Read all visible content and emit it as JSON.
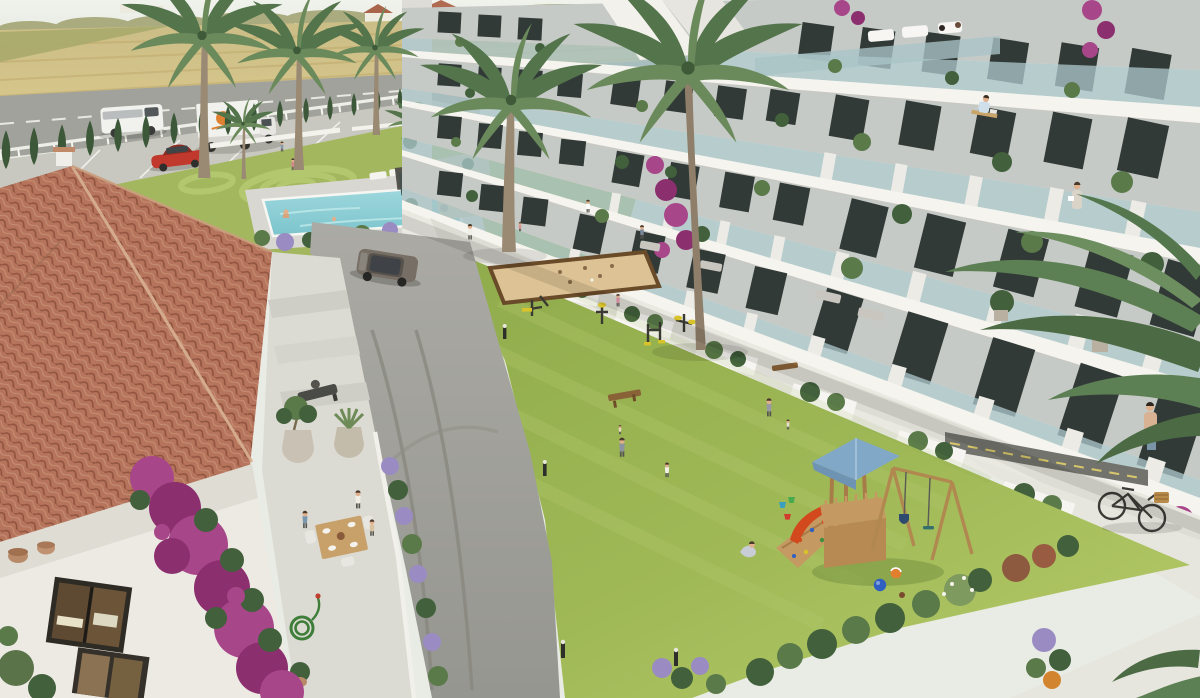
{
  "meta": {
    "title": "Aerial 3D architectural rendering of a coastal residential complex",
    "caption": "Bird's-eye render: white apartment block with tiered balconies on the right, central lawn courtyard with playground and outdoor gym, swimming pool, perimeter road with vehicles, and a terracotta-roofed Spanish house with dining terrace in the left foreground.",
    "width_px": 1200,
    "height_px": 698
  },
  "palette": {
    "sky": "#edf0ea",
    "fieldTan": "#d3c183",
    "fieldGreen": "#a8aa6c",
    "distantTrees": "#aaac80",
    "roadAsphalt": "#a2a29c",
    "parking": "#c8c8c0",
    "fenceWhite": "#eeeee8",
    "cypress": "#3c5839",
    "lawnUpper": "#a3b75f",
    "lawnMain": "#98b351",
    "lawnLight": "#b3c86c",
    "poolWater": "#8ed0d6",
    "poolDeck": "#d8d7d1",
    "gardenWall": "#f3f2ec",
    "driveway": "#a4a49e",
    "walkway": "#deddd5",
    "cornerPath": "#e7e6de",
    "accessRoad": "#73736d",
    "buildingWhite": "#f5f4ef",
    "buildingShade": "#c6cac6",
    "glassRail": "#a9c4c7",
    "windowDark": "#323a37",
    "partition": "#edebe6",
    "roofTile": "#b5745b",
    "roofTileDeep": "#8e523e",
    "roofTileLight": "#cb9a7e",
    "houseWall": "#eceae3",
    "terrace": "#dcdbd3",
    "bougainvillea": "#a8468a",
    "bougainvilleaDeep": "#8c2f6f",
    "leafGreen": "#5a7a4a",
    "leafDark": "#41603b",
    "lavender": "#9a8cc2",
    "sandCourt": "#dcc294",
    "sandBorder": "#6a4b29",
    "playWood": "#c59a62",
    "playRoof": "#81a8c6",
    "slideRed": "#d2491e",
    "ballBlue": "#2f5fc0",
    "ballOrange": "#e07f2e",
    "suv": "#776f66",
    "carRed": "#c0392c",
    "truckWhite": "#f1f1ee",
    "truckLogo": "#e0812f",
    "palmTrunk": "#9a8a74",
    "palmFrond": "#5d7f54",
    "palmFrondDark": "#4c6b45",
    "skin": "#e0b08d"
  },
  "scene": {
    "setting": "sunny coastal countryside, haze on horizon",
    "regions": [
      {
        "name": "farm-fields",
        "label": "Golden farm fields with distant farmhouses"
      },
      {
        "name": "perimeter-road",
        "label": "Road with white van and box truck"
      },
      {
        "name": "cypress-hedge",
        "label": "Row of cypress trees along white fence"
      },
      {
        "name": "parking-strip",
        "label": "Parking lane with red car"
      },
      {
        "name": "pool-garden",
        "label": "Lawn with circular mowing pattern and pool"
      },
      {
        "name": "swimming-pool",
        "label": "Rectangular pool with bathers and loungers"
      },
      {
        "name": "apartment-building",
        "label": "White apartment block, 4 tiers of glass balconies"
      },
      {
        "name": "ground-terraces",
        "label": "Ground-floor terraces with planters and shrubs"
      },
      {
        "name": "central-lawn",
        "label": "Large courtyard lawn"
      },
      {
        "name": "bocce-court",
        "label": "Sand petanque court with wooden border"
      },
      {
        "name": "outdoor-gym",
        "label": "Outdoor exercise machines with yellow seats"
      },
      {
        "name": "playground",
        "label": "Wooden play tower with blue roof, slide, climbing ramp, swings"
      },
      {
        "name": "spanish-house",
        "label": "Terracotta tiled roof house with dining terrace"
      },
      {
        "name": "house-terrace",
        "label": "Stone terrace, dining table with three people, olive and agave pots, coiled garden hose"
      },
      {
        "name": "bougainvillea",
        "label": "Magenta bougainvillea climbing the house wall"
      },
      {
        "name": "driveway",
        "label": "Curved asphalt path with SUV and bollard lights"
      },
      {
        "name": "bicycle",
        "label": "Bicycle with wicker basket on the path"
      },
      {
        "name": "palms",
        "label": "Tall palm trees across the grounds"
      }
    ],
    "vehicles": [
      {
        "name": "white-van",
        "color": "white"
      },
      {
        "name": "box-truck",
        "color": "white",
        "logo_color": "orange"
      },
      {
        "name": "red-car",
        "color": "red"
      },
      {
        "name": "suv",
        "color": "grey-brown"
      },
      {
        "name": "bicycle",
        "color": "black",
        "basket": "wicker"
      }
    ],
    "people": {
      "count_approx": 20,
      "activities": [
        "dining on terrace",
        "swimming",
        "walking",
        "playing on lawn",
        "gardening on balcony",
        "working at balcony desk",
        "children playing with buckets and balls"
      ]
    },
    "toys": {
      "balls": [
        "blue",
        "orange-white",
        "small brown"
      ],
      "buckets": [
        "green",
        "blue",
        "red"
      ]
    }
  }
}
